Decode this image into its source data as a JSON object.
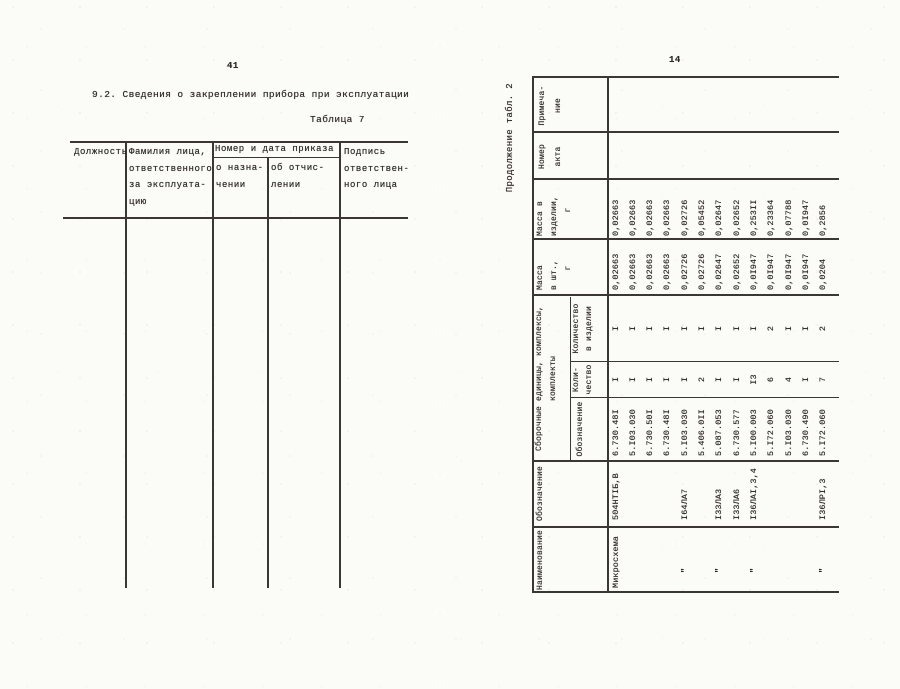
{
  "page_left": {
    "page_number": "41",
    "section_title": "9.2. Сведения о закреплении прибора при эксплуатации",
    "table_caption": "Таблица 7",
    "table7": {
      "col_position": "Должность",
      "col_person": [
        "Фамилия лица,",
        "ответственного",
        "за эксплуата-",
        "цию"
      ],
      "col_order_group": "Номер и дата приказа",
      "col_order_appoint": [
        "о назна-",
        "чении"
      ],
      "col_order_dismiss": [
        "об отчис-",
        "лении"
      ],
      "col_signature": [
        "Подпись",
        "ответствен-",
        "ного лица"
      ]
    }
  },
  "page_right": {
    "page_number": "14",
    "table_caption": "Продолжение табл. 2",
    "table2": {
      "headers": {
        "naimenovanie": "Наименование",
        "oboznachenie": "Обозначение",
        "group_line1": "Сборочные единицы, комплексы,",
        "group_line2": "комплекты",
        "sub_oboznachenie": "Обозначение",
        "sub_kolichestvo": [
          "Коли-",
          "чество"
        ],
        "sub_kol_v_izdelii": [
          "Количество",
          "в изделии"
        ],
        "massa_sht": [
          "Масса",
          "в шт.,",
          "г"
        ],
        "massa_izd": [
          "Масса в",
          "изделии,",
          "г"
        ],
        "nomer_akta": [
          "Номер",
          "акта"
        ],
        "primechanie": [
          "Примеча-",
          "ние"
        ]
      },
      "rows": [
        {
          "name": "Микросхема",
          "type": "504НТIБ,В",
          "designation": "6.730.48I",
          "qty": "I",
          "qty_in_product": "I",
          "mass_unit": "0,02663",
          "mass_in_product": "0,02663"
        },
        {
          "name": "",
          "type": "",
          "designation": "5.I03.030",
          "qty": "I",
          "qty_in_product": "I",
          "mass_unit": "0,02663",
          "mass_in_product": "0,02663"
        },
        {
          "name": "",
          "type": "",
          "designation": "6.730.50I",
          "qty": "I",
          "qty_in_product": "I",
          "mass_unit": "0,02663",
          "mass_in_product": "0,02663"
        },
        {
          "name": "",
          "type": "",
          "designation": "6.730.48I",
          "qty": "I",
          "qty_in_product": "I",
          "mass_unit": "0,02663",
          "mass_in_product": "0,02663"
        },
        {
          "name": "\"",
          "type": "I64ЛА7",
          "designation": "5.I03.030",
          "qty": "I",
          "qty_in_product": "I",
          "mass_unit": "0,02726",
          "mass_in_product": "0,02726"
        },
        {
          "name": "",
          "type": "",
          "designation": "5.406.0II",
          "qty": "2",
          "qty_in_product": "I",
          "mass_unit": "0,02726",
          "mass_in_product": "0,05452"
        },
        {
          "name": "\"",
          "type": "I33ЛА3",
          "designation": "5.087.053",
          "qty": "I",
          "qty_in_product": "I",
          "mass_unit": "0,02647",
          "mass_in_product": "0,02647"
        },
        {
          "name": "",
          "type": "I33ЛА6",
          "designation": "6.730.577",
          "qty": "I",
          "qty_in_product": "I",
          "mass_unit": "0,02652",
          "mass_in_product": "0,02652"
        },
        {
          "name": "\"",
          "type": "I36ЛАI,3,4",
          "designation": "5.I00.003",
          "qty": "I3",
          "qty_in_product": "I",
          "mass_unit": "0,0I947",
          "mass_in_product": "0,253II"
        },
        {
          "name": "",
          "type": "",
          "designation": "5.I72.060",
          "qty": "6",
          "qty_in_product": "2",
          "mass_unit": "0,0I947",
          "mass_in_product": "0,23364"
        },
        {
          "name": "",
          "type": "",
          "designation": "5.I03.030",
          "qty": "4",
          "qty_in_product": "I",
          "mass_unit": "0,0I947",
          "mass_in_product": "0,07788"
        },
        {
          "name": "",
          "type": "",
          "designation": "6.730.490",
          "qty": "I",
          "qty_in_product": "I",
          "mass_unit": "0,0I947",
          "mass_in_product": "0,0I947"
        },
        {
          "name": "\"",
          "type": "I36ЛРI,3",
          "designation": "5.I72.060",
          "qty": "7",
          "qty_in_product": "2",
          "mass_unit": "0,0204",
          "mass_in_product": "0,2856"
        }
      ]
    }
  }
}
